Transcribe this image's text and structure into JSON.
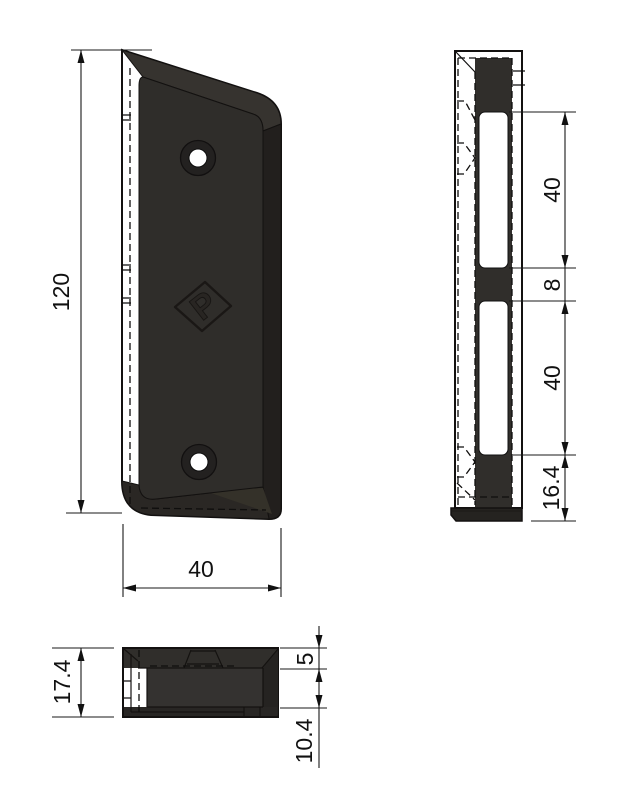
{
  "drawing": {
    "type": "technical-part-drawing",
    "background": "#ffffff",
    "line_color": "#1a1a1a",
    "part_color": "#2b2926",
    "slot_color": "#ffffff",
    "logo": {
      "letter": "P"
    },
    "views": [
      {
        "name": "front-view",
        "dims": [
          "120",
          "40"
        ]
      },
      {
        "name": "side-view",
        "dims": [
          "40",
          "8",
          "40",
          "16.4"
        ]
      },
      {
        "name": "bottom-view",
        "dims": [
          "17.4",
          "5",
          "10.4"
        ]
      }
    ]
  },
  "dimensions": {
    "front_height": "120",
    "front_width": "40",
    "side_slot_top": "40",
    "side_gap": "8",
    "side_slot_bottom": "40",
    "side_bottom": "16.4",
    "bottom_total": "17.4",
    "bottom_top": "5",
    "bottom_inner": "10.4"
  }
}
